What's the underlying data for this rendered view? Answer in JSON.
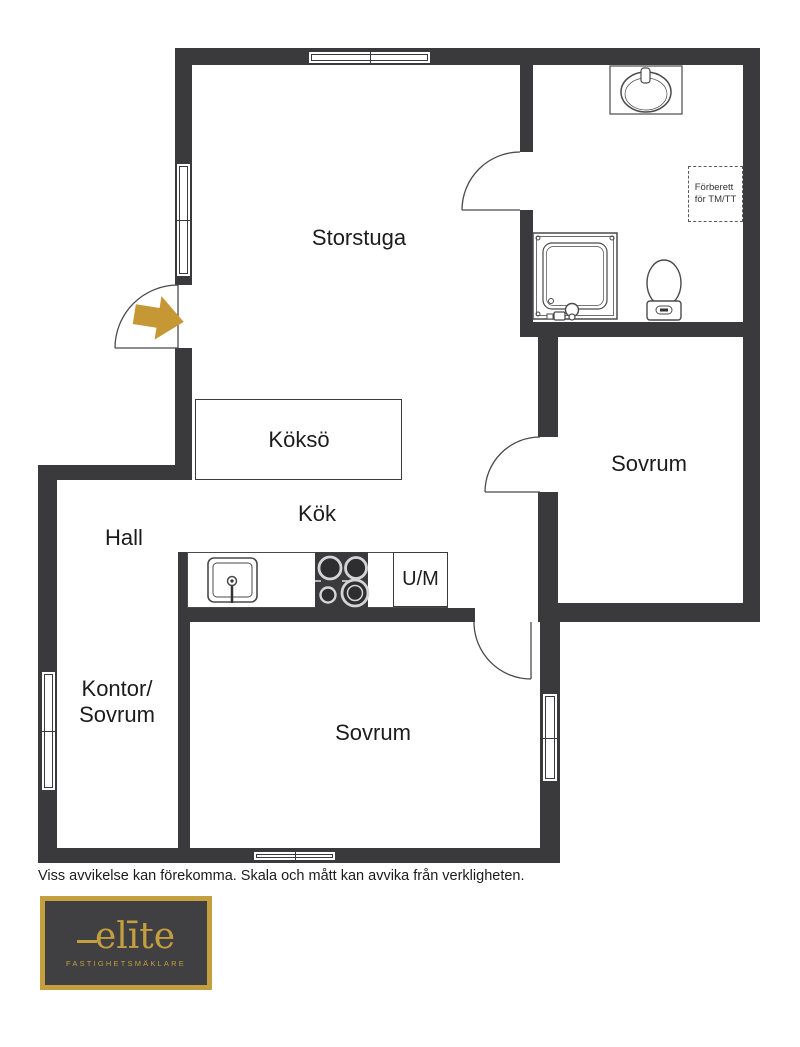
{
  "colors": {
    "wall": "#3a3a3c",
    "fixture_line": "#4a4a4a",
    "entry_arrow_gold": "#c69735",
    "logo_gold": "#c49f40",
    "logo_background": "#403f41",
    "label_text": "#1c1c1c"
  },
  "rooms": {
    "storstuga": "Storstuga",
    "kokso": "Köksö",
    "kok": "Kök",
    "hall": "Hall",
    "kontor_sovrum_line1": "Kontor/",
    "kontor_sovrum_line2": "Sovrum",
    "sovrum_right": "Sovrum",
    "sovrum_bottom": "Sovrum",
    "um": "U/M"
  },
  "annotations": {
    "forberett_line1": "Förberett",
    "forberett_line2": "för TM/TT"
  },
  "fixtures": [
    "entry-arrow",
    "bathroom-sink",
    "toilet",
    "shower",
    "kitchen-sink",
    "stove",
    "kitchen-island",
    "dishwasher"
  ],
  "disclaimer": "Viss avvikelse kan förekomma. Skala och mått kan avvika från verkligheten.",
  "logo": {
    "brand": "elīte",
    "tagline": "FASTIGHETSMÄKLARE"
  }
}
